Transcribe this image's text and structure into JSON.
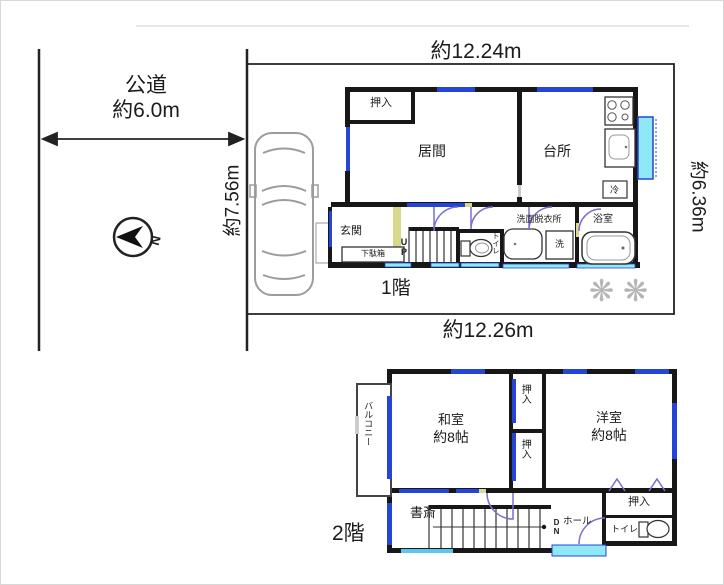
{
  "site": {
    "road_name": "公道",
    "road_width": "約6.0m",
    "north_label": "N"
  },
  "lot": {
    "width_top": "約12.24m",
    "depth_right": "約6.36m",
    "width_bottom": "約12.26m",
    "depth_left": "約7.56m"
  },
  "floor1": {
    "label": "1階",
    "rooms": {
      "closet": "押入",
      "living": "居間",
      "kitchen": "台所",
      "entrance": "玄関",
      "shoe_cabinet": "下駄箱",
      "stairs": "UP",
      "toilet": "トイレ",
      "washroom": "洗面脱衣所",
      "washer": "洗",
      "fridge": "冷",
      "bath": "浴室"
    }
  },
  "floor2": {
    "label": "2階",
    "rooms": {
      "balcony": "バルコニー",
      "japanese_room": "和室",
      "japanese_room_size": "約8帖",
      "closet_upper": "押入",
      "closet_lower": "押入",
      "western_room": "洋室",
      "western_room_size": "約8帖",
      "study": "書斎",
      "stairs": "DN",
      "hall": "ホール",
      "closet_right": "押入",
      "toilet": "トイレ"
    }
  },
  "decor": {
    "snowflake": "❋"
  },
  "colors": {
    "wall": "#171717",
    "window_blue": "#2545d8",
    "window_cyan": "#8ee9f4",
    "door_arc": "#7a6fd0",
    "accent_yellow": "#d9d98e"
  }
}
